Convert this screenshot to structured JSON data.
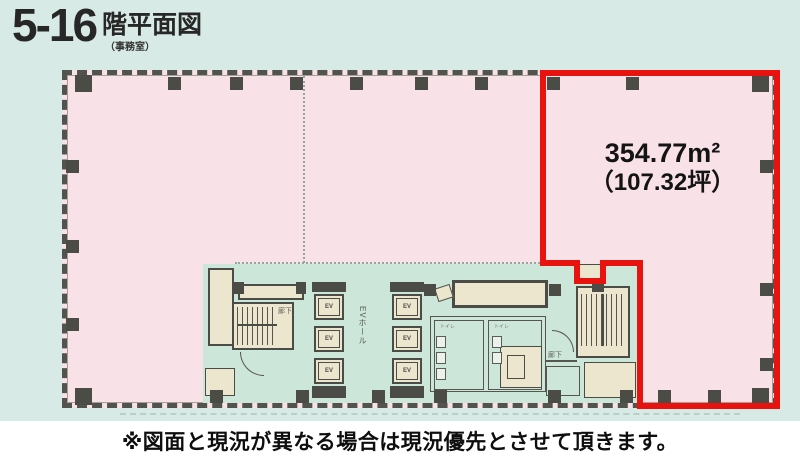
{
  "title": {
    "floors": "5-16",
    "suffix": "階平面図",
    "sub": "（事務室）"
  },
  "unit": {
    "area_m2": "354.77m²",
    "area_tsubo": "（107.32坪）",
    "outline_color": "#e8120e"
  },
  "core": {
    "ev_hall_label": "EVホール",
    "ev_labels": [
      "EV",
      "EV",
      "EV",
      "EV",
      "EV",
      "EV"
    ],
    "corridor_left_label": "廊下",
    "corridor_right_label": "廊下",
    "toilet_left_label": "トイレ",
    "toilet_right_label": "トイレ"
  },
  "footer": {
    "note": "※図面と現況が異なる場合は現況優先とさせて頂きます。"
  },
  "colors": {
    "page_background": "#d8eae5",
    "plan_pink": "#f8e2e8",
    "core_mint": "#cde6da",
    "room_beige": "#ece6cf",
    "wall_dark": "#4c4c46",
    "unit_red": "#e8120e"
  }
}
